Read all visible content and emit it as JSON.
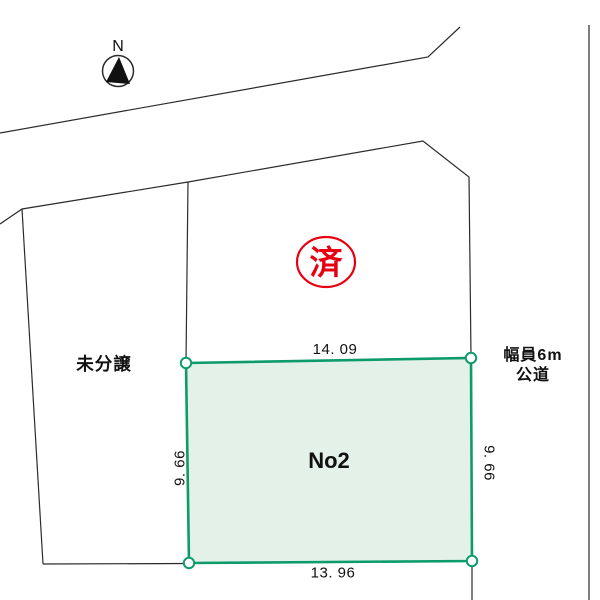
{
  "compass": {
    "north_label": "N"
  },
  "plots": {
    "unsold": {
      "label": "未分譲"
    },
    "middle": {
      "stamp_label": "済"
    },
    "no2": {
      "label": "No2",
      "dim_top": "14. 09",
      "dim_bottom": "13. 96",
      "dim_left": "9. 66",
      "dim_right": "9. 66"
    }
  },
  "road": {
    "label_line1": "幅員6m",
    "label_line2": "公道"
  },
  "colors": {
    "lot_fill": "#e4f1e9",
    "lot_stroke": "#0d9b6b",
    "stamp_red": "#e60012",
    "boundary_black": "#2b2b2b",
    "road_edge_gray": "#7e7e7e"
  }
}
